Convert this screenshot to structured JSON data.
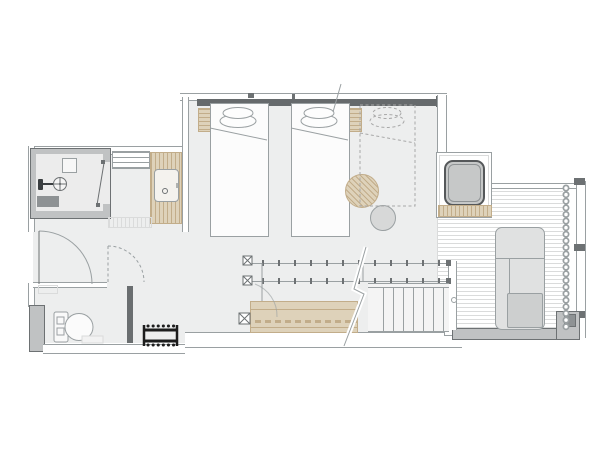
{
  "title": "studio-room-floor-plan",
  "canvas": {
    "width": 613,
    "height": 460
  },
  "colors": {
    "background": "#ffffff",
    "floor": "#edeeee",
    "wall_fill": "#c0c2c3",
    "wall_line": "#9aa0a2",
    "line_dark": "#6d7173",
    "headboard": "#666a6c",
    "wood": "#ded2ba",
    "wood_line": "#c2ad8a",
    "tub_fill": "#c6c8c8",
    "tub_border": "#55585a",
    "chaise_fill": "#e0e1e1",
    "cushion_fill": "#cdcfcf",
    "table_gray": "#d7d8d8",
    "deck_line": "#dadbdb",
    "dash": "#a8a8a8",
    "fixture_dark": "#3a3e40",
    "mat_gray": "#8e9294",
    "dark_wall": "#6a6e70",
    "black": "#1d1d1d"
  },
  "rooms": [
    {
      "name": "shower-room"
    },
    {
      "name": "vanity-area"
    },
    {
      "name": "entry-hall"
    },
    {
      "name": "toilet-room"
    },
    {
      "name": "bedroom"
    },
    {
      "name": "terrace-deck"
    },
    {
      "name": "stair-area"
    }
  ],
  "furniture": [
    "twin-bed-1",
    "twin-bed-2",
    "alternate-bed-dashed",
    "nightstand-left",
    "nightstand-right",
    "round-stool-wood",
    "round-table-gray",
    "bathtub",
    "chaise-lounge",
    "work-counter",
    "staircase",
    "shower-head",
    "shower-mat",
    "wall-niche",
    "towel-shelf",
    "vanity-counter",
    "sink",
    "toilet",
    "toilet-mat",
    "luggage-rack",
    "entry-door",
    "toilet-door-dashed",
    "shower-door",
    "curtain",
    "window-wall",
    "hanging-rails",
    "floor-outlet-boxes"
  ]
}
